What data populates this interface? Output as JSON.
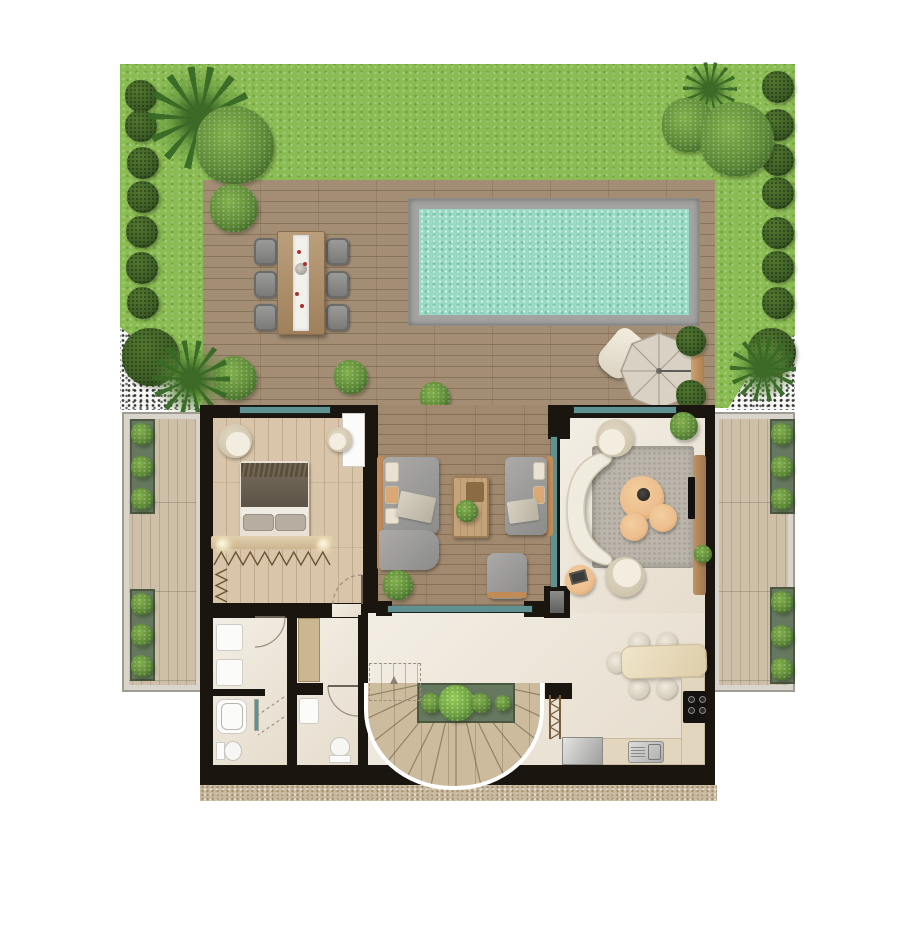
{
  "title": "Villa ground-floor plan with garden, pool deck and terraces",
  "palette": {
    "lawn": "#8bbc53",
    "deck": "#a38e75",
    "lounge_floor": "#a0896f",
    "pool_water": "#98d9c4",
    "pool_coping": "#a3a3a1",
    "wall": "#1a150f",
    "glass": "#5f9193",
    "bedroom_floor": "#d8c5aa",
    "cream_floor": "#ece4d6",
    "terrace_floor": "#cdbfa8",
    "rug": "#bbb5ab",
    "sofa_gray": "#9e9e9c",
    "wood_trim": "#c08b57",
    "cream_furniture": "#eae4d4",
    "table_tan": "#edbd8d",
    "counter": "#e2d6bf",
    "stair_wood": "#cdbb9d",
    "umbrella": "#d9d2c4",
    "gravel": "#c9b99f",
    "white_gravel": "#f6f6f4",
    "shrub_dark": "#3c5d26",
    "shrub_mid": "#5e8a38",
    "planter_box": "#66785f"
  },
  "rooms": [
    "garden",
    "pool-deck",
    "swimming-pool",
    "outdoor-dining",
    "bedroom",
    "lounge",
    "living-room",
    "hallway",
    "bathroom",
    "wc",
    "kitchen-dining",
    "staircase",
    "left-terrace",
    "right-terrace"
  ],
  "garden": {
    "shrubs": [
      {
        "x": 125,
        "y": 80,
        "d": 32,
        "v": "shrub"
      },
      {
        "x": 125,
        "y": 110,
        "d": 32,
        "v": "shrub"
      },
      {
        "x": 127,
        "y": 147,
        "d": 32,
        "v": "shrub"
      },
      {
        "x": 127,
        "y": 181,
        "d": 32,
        "v": "shrub"
      },
      {
        "x": 126,
        "y": 216,
        "d": 32,
        "v": "shrub"
      },
      {
        "x": 126,
        "y": 252,
        "d": 32,
        "v": "shrub"
      },
      {
        "x": 127,
        "y": 287,
        "d": 32,
        "v": "shrub"
      },
      {
        "x": 762,
        "y": 71,
        "d": 32,
        "v": "shrub"
      },
      {
        "x": 762,
        "y": 109,
        "d": 32,
        "v": "shrub"
      },
      {
        "x": 762,
        "y": 144,
        "d": 32,
        "v": "shrub"
      },
      {
        "x": 762,
        "y": 177,
        "d": 32,
        "v": "shrub"
      },
      {
        "x": 762,
        "y": 217,
        "d": 32,
        "v": "shrub"
      },
      {
        "x": 762,
        "y": 251,
        "d": 32,
        "v": "shrub"
      },
      {
        "x": 762,
        "y": 287,
        "d": 32,
        "v": "shrub"
      },
      {
        "x": 148,
        "y": 66,
        "d": 104,
        "v": "palm"
      },
      {
        "x": 196,
        "y": 106,
        "d": 78,
        "v": "tree"
      },
      {
        "x": 683,
        "y": 62,
        "d": 54,
        "v": "palm"
      },
      {
        "x": 662,
        "y": 98,
        "d": 54,
        "v": "tree"
      },
      {
        "x": 700,
        "y": 102,
        "d": 74,
        "v": "tree"
      },
      {
        "x": 210,
        "y": 184,
        "d": 48,
        "v": "tree"
      },
      {
        "x": 213,
        "y": 356,
        "d": 44,
        "v": "tree"
      },
      {
        "x": 334,
        "y": 360,
        "d": 34,
        "v": "tree"
      },
      {
        "x": 420,
        "y": 382,
        "d": 30,
        "v": "tree"
      },
      {
        "x": 676,
        "y": 326,
        "d": 30,
        "v": "shrub"
      },
      {
        "x": 676,
        "y": 380,
        "d": 30,
        "v": "shrub"
      },
      {
        "x": 122,
        "y": 328,
        "d": 58,
        "v": "shrub"
      },
      {
        "x": 152,
        "y": 340,
        "d": 78,
        "v": "palm"
      },
      {
        "x": 748,
        "y": 328,
        "d": 48,
        "v": "shrub"
      },
      {
        "x": 730,
        "y": 336,
        "d": 66,
        "v": "palm"
      }
    ]
  },
  "house_plants": [
    {
      "x": 383,
      "y": 570,
      "d": 30
    },
    {
      "x": 456,
      "y": 500,
      "d": 22
    },
    {
      "x": 670,
      "y": 412,
      "d": 28
    },
    {
      "x": 694,
      "y": 545,
      "d": 18
    }
  ],
  "outdoor_dining": {
    "chairs": [
      [
        254,
        238
      ],
      [
        254,
        271
      ],
      [
        254,
        304
      ],
      [
        326,
        238
      ],
      [
        326,
        271
      ],
      [
        326,
        304
      ]
    ],
    "petals": [
      [
        297,
        250
      ],
      [
        303,
        262
      ],
      [
        295,
        292
      ],
      [
        300,
        304
      ]
    ]
  },
  "kitchen": {
    "chairs": [
      [
        628,
        632
      ],
      [
        656,
        632
      ],
      [
        628,
        678
      ],
      [
        656,
        678
      ],
      [
        606,
        652
      ]
    ],
    "burners": [
      [
        688,
        696
      ],
      [
        699,
        696
      ],
      [
        688,
        707
      ],
      [
        699,
        707
      ]
    ]
  },
  "hangers": [
    {
      "x": 214,
      "y": 550,
      "w": 116,
      "h": 17,
      "n": 8,
      "dir": "h"
    },
    {
      "x": 214,
      "y": 569,
      "w": 15,
      "h": 33,
      "n": 3,
      "dir": "v"
    },
    {
      "x": 300,
      "y": 621,
      "w": 18,
      "h": 60,
      "n": 5,
      "dir": "v"
    }
  ],
  "stairs": {
    "tread_count": 13
  },
  "stair_planter": {
    "plants": [
      [
        14,
        20
      ],
      [
        40,
        36
      ],
      [
        64,
        20
      ],
      [
        86,
        16
      ]
    ]
  },
  "terrace_planters": [
    {
      "x": 130,
      "y": 419,
      "w": 25,
      "h": 95
    },
    {
      "x": 130,
      "y": 589,
      "w": 25,
      "h": 92
    },
    {
      "x": 770,
      "y": 419,
      "w": 25,
      "h": 95
    },
    {
      "x": 770,
      "y": 587,
      "w": 25,
      "h": 97
    }
  ]
}
